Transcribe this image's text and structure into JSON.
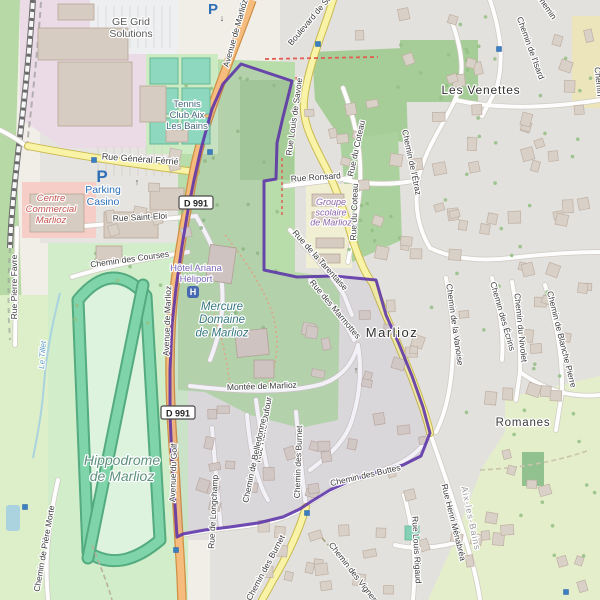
{
  "map": {
    "colors": {
      "background": "#f1eee8",
      "residential": "#e3e1dd",
      "industrial": "#eadbe6",
      "retail": "#f7cdc7",
      "school": "#f0efd3",
      "forest": "#a6cd97",
      "park": "#b9dcab",
      "meadow": "#e5eecb",
      "hippodrome_grounds": "#d2edca",
      "track_green": "#7fd4a9",
      "track_casing": "#54ab80",
      "water": "#aad3df",
      "primary_road": "#f6bc7d",
      "secondary_road": "#f8f3a6",
      "minor_road": "#fdfdfd",
      "boundary_purple": "#5b32a8",
      "marker_blue": "#3a7fc1",
      "parking_blue": "#2f6fb7"
    },
    "badges": [
      {
        "label": "D 991",
        "x": 196,
        "y": 203
      },
      {
        "label": "D 991",
        "x": 178,
        "y": 413
      }
    ],
    "parking_icons": [
      {
        "label": "P",
        "x": 213,
        "y": 14,
        "size": 15
      },
      {
        "label": "P",
        "x": 102,
        "y": 182,
        "size": 17
      }
    ],
    "heliport_icon": {
      "label": "H",
      "x": 193,
      "y": 292
    },
    "oneway_arrows": [
      {
        "glyph": "↓",
        "x": 222,
        "y": 21
      },
      {
        "glyph": "↑",
        "x": 137,
        "y": 185
      },
      {
        "glyph": "↑",
        "x": 356,
        "y": 373
      }
    ],
    "traffic_markers": [
      [
        243,
        6
      ],
      [
        318,
        44
      ],
      [
        499,
        49
      ],
      [
        94,
        160
      ],
      [
        210,
        152
      ],
      [
        354,
        227
      ],
      [
        354,
        234
      ],
      [
        307,
        513
      ],
      [
        176,
        550
      ],
      [
        25,
        507
      ],
      [
        566,
        592
      ]
    ],
    "labels": {
      "places": [
        {
          "text": "Marlioz",
          "x": 392,
          "y": 337,
          "size": 13,
          "color": "#2f2f2f",
          "ls": 1.5
        },
        {
          "text": "Les Venettes",
          "x": 481,
          "y": 94,
          "size": 12,
          "color": "#2f2f2f",
          "ls": 0.8
        },
        {
          "text": "Romanes",
          "x": 523,
          "y": 426,
          "size": 11.5,
          "color": "#3a3a3a",
          "ls": 0.8
        }
      ],
      "streets": [
        {
          "text": "Avenue de Marlioz",
          "x": 238,
          "y": 34,
          "rotate": -74
        },
        {
          "text": "Avenue de Marlioz",
          "x": 170,
          "y": 321,
          "rotate": -88
        },
        {
          "text": "Avenue du Golf",
          "x": 176,
          "y": 473,
          "rotate": -88
        },
        {
          "text": "Rue Général Férrié",
          "x": 140,
          "y": 162,
          "rotate": 4,
          "size": 9
        },
        {
          "text": "Rue Saint-Eloi",
          "x": 140,
          "y": 220,
          "rotate": -3
        },
        {
          "text": "Chemin des Courses",
          "x": 130,
          "y": 262,
          "rotate": -8
        },
        {
          "text": "Rue Pierre Favre",
          "x": 17,
          "y": 287,
          "rotate": -90
        },
        {
          "text": "Montée de Marlioz",
          "x": 262,
          "y": 389,
          "rotate": -2
        },
        {
          "text": "Boulevard de Savoie",
          "x": 317,
          "y": 16,
          "rotate": -50
        },
        {
          "text": "Rue Louis de Savoie",
          "x": 297,
          "y": 117,
          "rotate": -82
        },
        {
          "text": "Rue du Coteau",
          "x": 359,
          "y": 149,
          "rotate": -78
        },
        {
          "text": "Rue du Coteau",
          "x": 357,
          "y": 212,
          "rotate": -88
        },
        {
          "text": "Rue Ronsard",
          "x": 316,
          "y": 180,
          "rotate": -4
        },
        {
          "text": "Rue de la Tarentaise",
          "x": 318,
          "y": 262,
          "rotate": 48
        },
        {
          "text": "Rue des Marmottes",
          "x": 333,
          "y": 311,
          "rotate": 50
        },
        {
          "text": "Chemin de l'Étraz",
          "x": 409,
          "y": 163,
          "rotate": 78
        },
        {
          "text": "Chemin de l'Isard",
          "x": 528,
          "y": 49,
          "rotate": 70
        },
        {
          "text": "Chemin de la Vanoise",
          "x": 452,
          "y": 325,
          "rotate": 82
        },
        {
          "text": "Chemin des Écrins",
          "x": 500,
          "y": 317,
          "rotate": 74
        },
        {
          "text": "Chemin du Nivolet",
          "x": 518,
          "y": 328,
          "rotate": 84
        },
        {
          "text": "Chemin de Blanche Pierre",
          "x": 559,
          "y": 340,
          "rotate": 76
        },
        {
          "text": "Chemin des Buttes",
          "x": 366,
          "y": 478,
          "rotate": -13
        },
        {
          "text": "Rue Henri Ménabréa",
          "x": 451,
          "y": 523,
          "rotate": 76
        },
        {
          "text": "Rue Louis Rigaud",
          "x": 414,
          "y": 550,
          "rotate": 87
        },
        {
          "text": "Chemin des Vignes",
          "x": 351,
          "y": 574,
          "rotate": 52
        },
        {
          "text": "Rue de Longchamp",
          "x": 216,
          "y": 512,
          "rotate": -87
        },
        {
          "text": "Rue René Dufour",
          "x": 266,
          "y": 430,
          "rotate": -80
        },
        {
          "text": "Chemin de Belledonne",
          "x": 257,
          "y": 461,
          "rotate": -78
        },
        {
          "text": "Chemin des Burnet",
          "x": 301,
          "y": 462,
          "rotate": -88
        },
        {
          "text": "Chemin des Burnet",
          "x": 268,
          "y": 569,
          "rotate": -62
        },
        {
          "text": "Chemin de Pière Morte",
          "x": 47,
          "y": 549,
          "rotate": -80
        },
        {
          "text": "Le Tillet",
          "x": 45,
          "y": 355,
          "rotate": -86,
          "color": "#5a9bbf",
          "italic": true,
          "size": 8
        },
        {
          "text": "Aix-les-Bains",
          "x": 468,
          "y": 519,
          "rotate": 78,
          "color": "#9a9a9a",
          "size": 9,
          "ls": 1
        },
        {
          "text": "Chemin",
          "x": 596,
          "y": 82,
          "rotate": 84
        },
        {
          "text": "Chemin",
          "x": 544,
          "y": 8,
          "rotate": 55
        }
      ],
      "pois": [
        {
          "lines": [
            "GE Grid",
            "Solutions"
          ],
          "x": 131,
          "y": 25,
          "size": 10.5,
          "color": "#5a5a5a"
        },
        {
          "lines": [
            "Tennis",
            "Club Aix",
            "Les Bains"
          ],
          "x": 187,
          "y": 107,
          "size": 9.5,
          "color": "#44687d"
        },
        {
          "lines": [
            "Centre",
            "Commercial",
            "Marlioz"
          ],
          "x": 51,
          "y": 201,
          "size": 9.5,
          "color": "#c4524e",
          "italic": true
        },
        {
          "lines": [
            "Parking",
            "Casino"
          ],
          "x": 103,
          "y": 193,
          "size": 10.5,
          "color": "#2a6fba"
        },
        {
          "lines": [
            "Hôtel Ariana",
            "Héliport"
          ],
          "x": 196,
          "y": 271,
          "size": 9.5,
          "color": "#7a68b8"
        },
        {
          "lines": [
            "Mercure",
            "Domaine",
            "de Marlioz"
          ],
          "x": 222,
          "y": 310,
          "size": 11.5,
          "color": "#34767e",
          "italic": true
        },
        {
          "lines": [
            "Groupe",
            "scolaire",
            "de Marlioz"
          ],
          "x": 331,
          "y": 205,
          "size": 9,
          "color": "#8a63a8",
          "italic": true
        },
        {
          "lines": [
            "Hippodrome",
            "de Marlioz"
          ],
          "x": 122,
          "y": 465,
          "size": 14,
          "color": "#5f9180",
          "italic": true
        }
      ]
    }
  }
}
